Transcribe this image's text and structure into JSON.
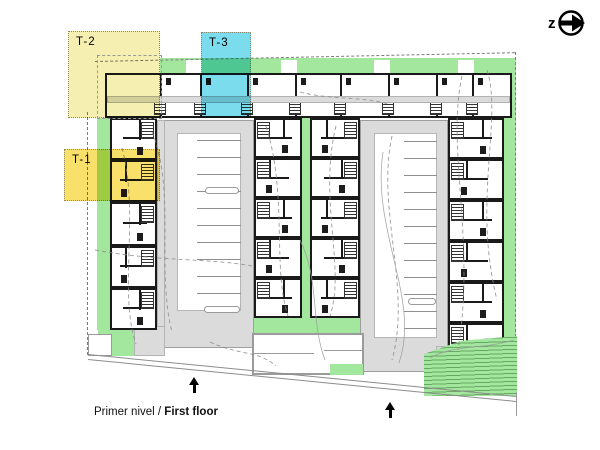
{
  "north_arrow": {
    "label": "z"
  },
  "unit_types": [
    {
      "id": "t1",
      "label": "T-1"
    },
    {
      "id": "t2",
      "label": "T-2"
    },
    {
      "id": "t3",
      "label": "T-3"
    }
  ],
  "caption": {
    "es": "Primer nivel / ",
    "en_bold": "First floor"
  },
  "colors": {
    "green": "#A3E79E",
    "pave": "#DBDBDB",
    "wall": "#1A1A1A",
    "t1": "#F8E06A",
    "t2": "#F5F0B2",
    "t3": "#7BDCEE",
    "line": "#8F8F8F"
  }
}
